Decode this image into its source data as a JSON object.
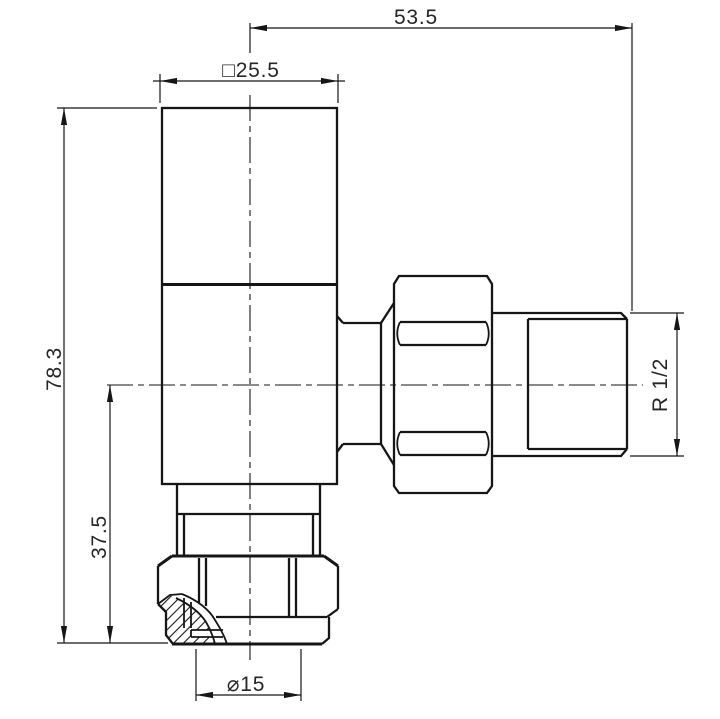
{
  "drawing": {
    "background": "#ffffff",
    "line_color": "#161616",
    "text_color": "#262626",
    "dimensions": {
      "offset_width": "53.5",
      "head_square": "□25.5",
      "overall_height": "78.3",
      "inlet_height": "37.5",
      "thread": "R 1/2",
      "pipe_diameter": "⌀15"
    }
  }
}
